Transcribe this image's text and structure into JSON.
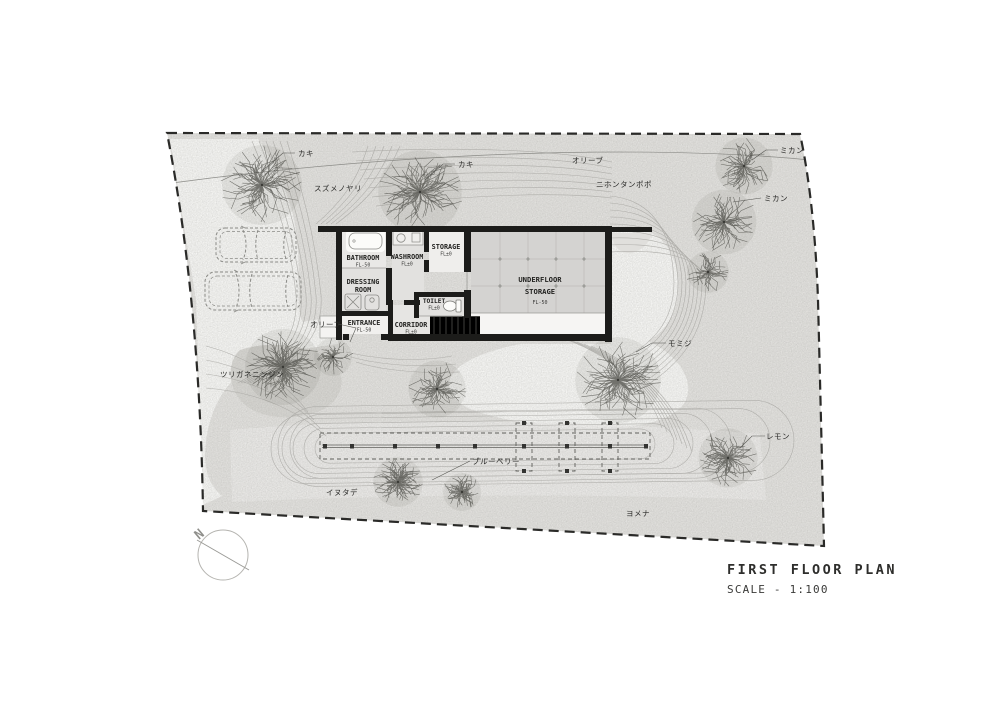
{
  "title_block": {
    "title": "FIRST FLOOR PLAN",
    "scale": "SCALE - 1:100"
  },
  "north_arrow": {
    "label": "N"
  },
  "rooms": {
    "bathroom": {
      "name": "BATHROOM",
      "level": "FL-50"
    },
    "washroom": {
      "name": "WASHROOM",
      "level": "FL±0"
    },
    "storage": {
      "name": "STORAGE",
      "level": "FL±0"
    },
    "dressing": {
      "line1": "DRESSING",
      "line2": "ROOM"
    },
    "toilet": {
      "name": "TOILET",
      "level": "FL±0"
    },
    "entrance": {
      "name": "ENTRANCE",
      "level": "FL-50"
    },
    "corridor": {
      "name": "CORRIDOR",
      "level": "FL±0"
    },
    "underfloor": {
      "line1": "UNDERFLOOR",
      "line2": "STORAGE",
      "level": "FL-50"
    }
  },
  "plants": {
    "kaki_west": {
      "label": "カキ"
    },
    "kaki_center": {
      "label": "カキ"
    },
    "olive_row": {
      "label": "オリーブ"
    },
    "suzumenoyari": {
      "label": "スズメノヤリ"
    },
    "nihon_tanpopo": {
      "label": "ニホンタンポポ"
    },
    "mikan_upper": {
      "label": "ミカン"
    },
    "mikan_lower": {
      "label": "ミカン"
    },
    "olive_garden": {
      "label": "オリーブ"
    },
    "tsuriganeninjin": {
      "label": "ツリガネニンジン"
    },
    "momiji": {
      "label": "モミジ"
    },
    "lemon": {
      "label": "レモン"
    },
    "blueberry": {
      "label": "ブルーベリー"
    },
    "inutade": {
      "label": "イヌタデ"
    },
    "yomena": {
      "label": "ヨメナ"
    }
  },
  "colors": {
    "wall": "#1c1c1a",
    "site_fill": "#e4e3e0",
    "paving": "#f8f8f6",
    "contour": "#a8a7a3",
    "boundary": "#2a2a28"
  }
}
